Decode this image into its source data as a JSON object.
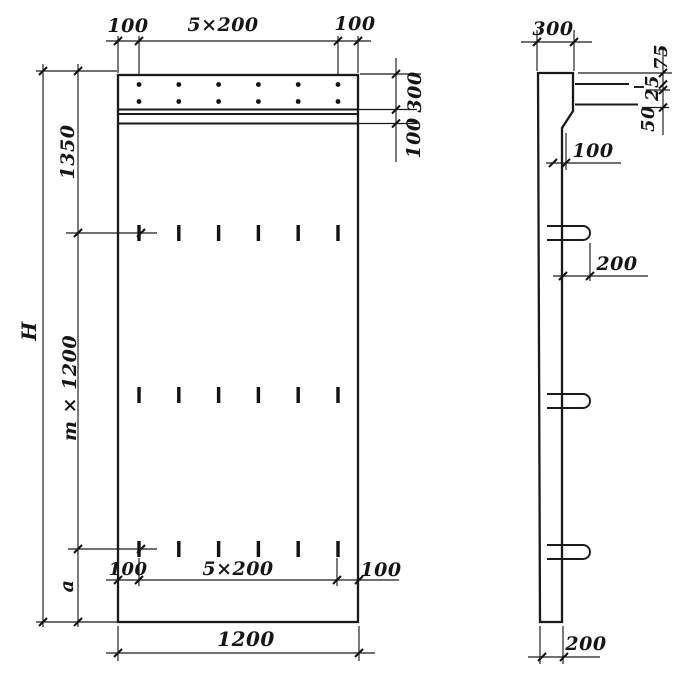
{
  "front_view": {
    "top": {
      "left": "100",
      "center": "5×200",
      "right": "100"
    },
    "right": {
      "band": "300",
      "ledge": "100"
    },
    "left": {
      "overall": "H",
      "upper": "1350",
      "module": "m × 1200",
      "lower": "a"
    },
    "bottom": {
      "left": "100",
      "center": "5×200",
      "right": "100",
      "overall": "1200"
    }
  },
  "side_view": {
    "top_width": "300",
    "right": {
      "top": "75",
      "middle": "25",
      "bottom": "50"
    },
    "recess": "100",
    "loop": "200",
    "bottom_width": "200"
  }
}
